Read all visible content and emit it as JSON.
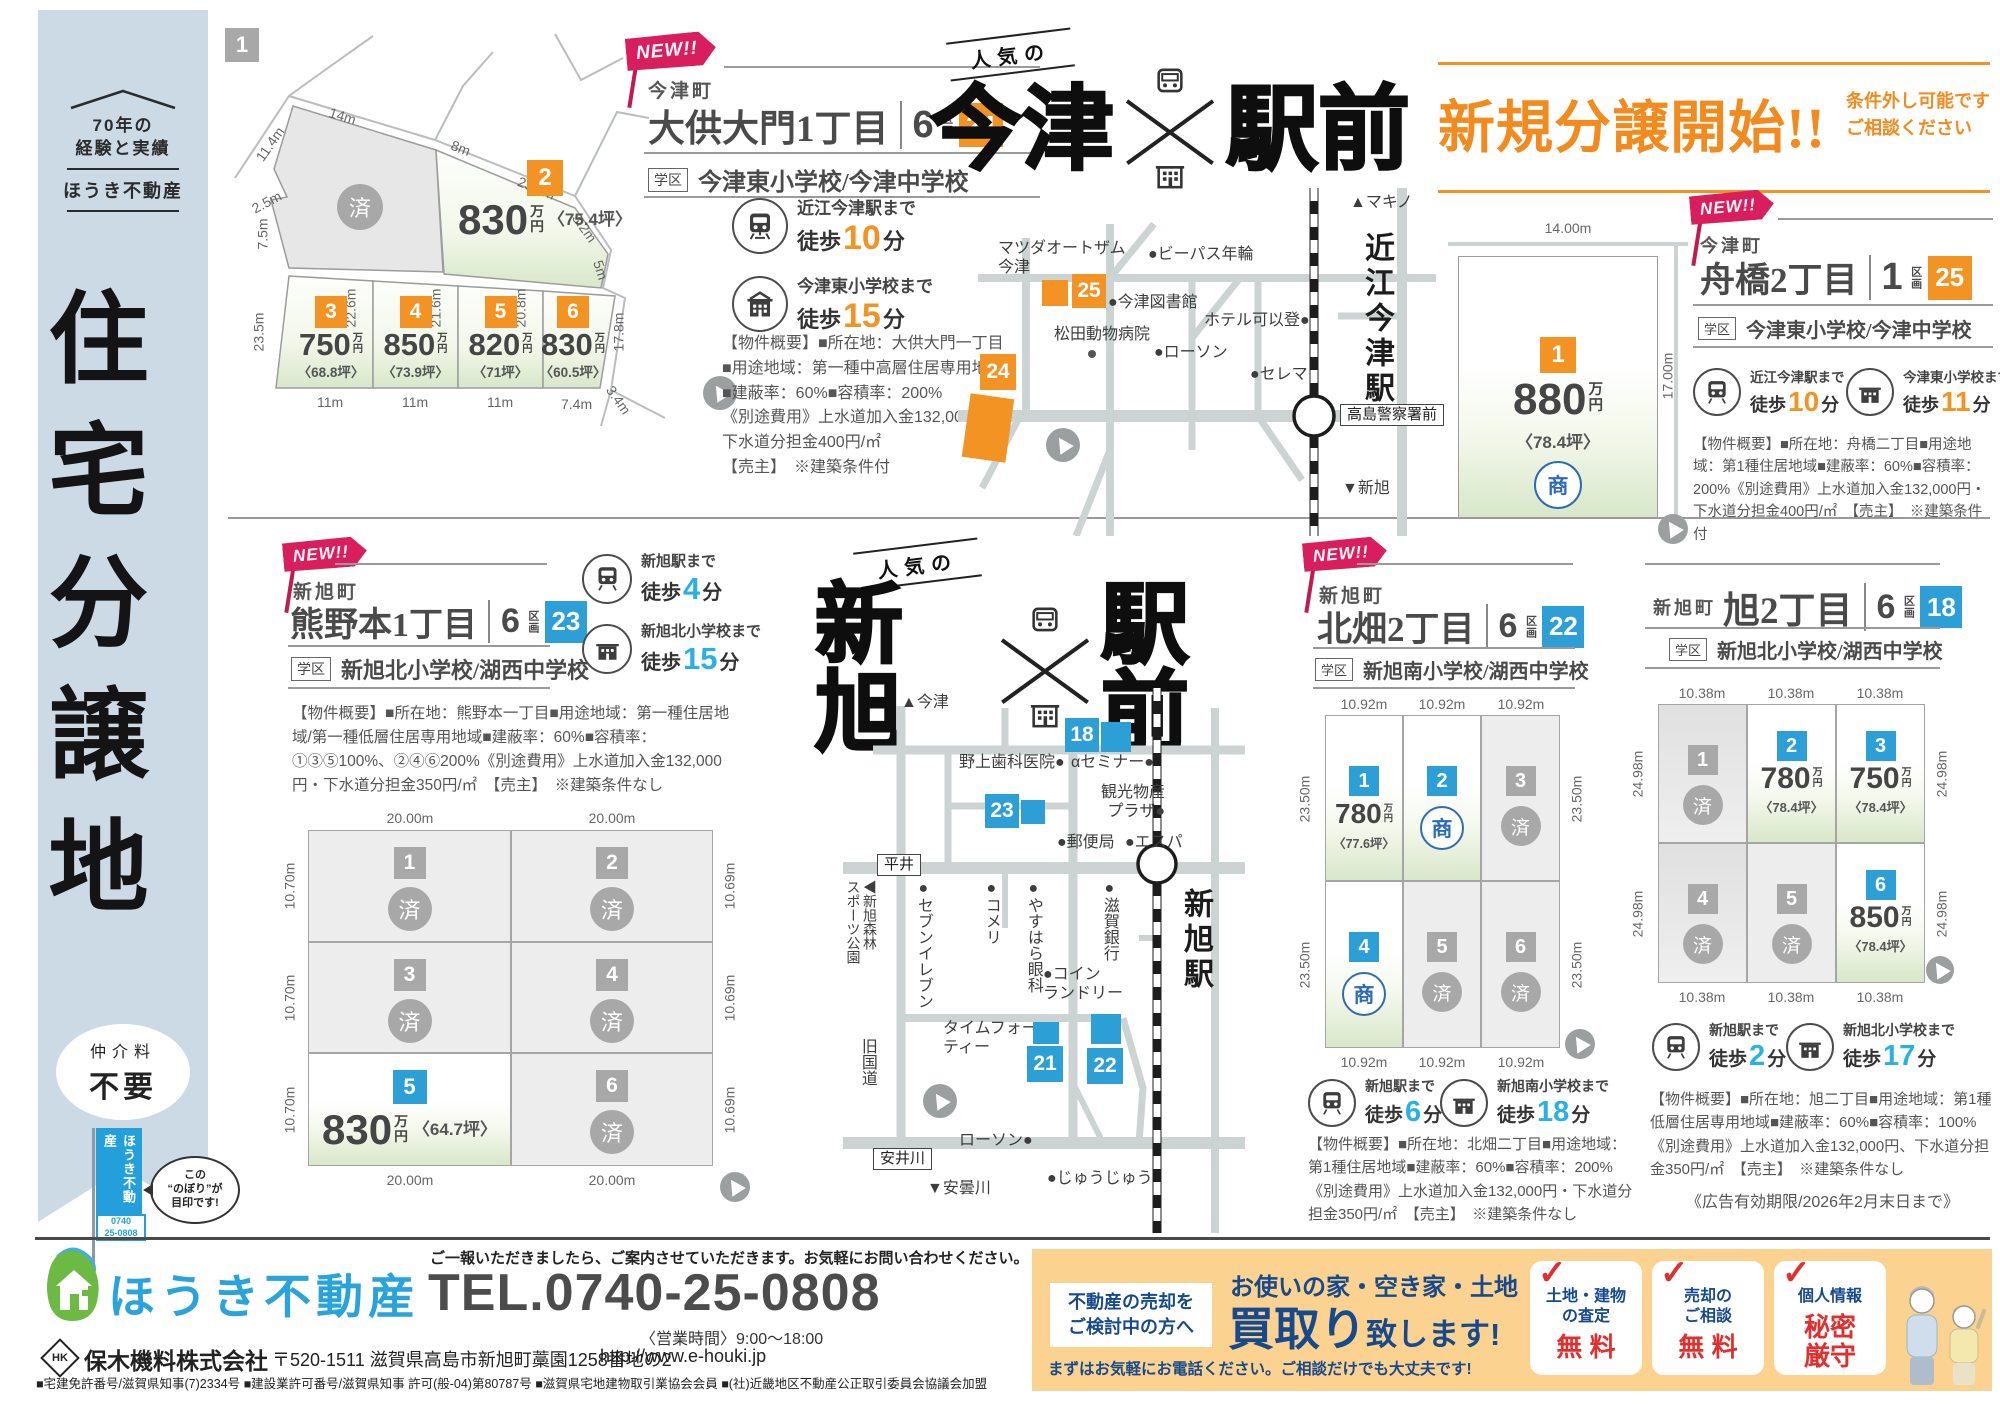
{
  "units": {
    "new": "NEW!!",
    "ku": "区画",
    "gakku": "学区",
    "walk": "徒歩",
    "min": "分",
    "man": "万",
    "yen": "円",
    "sold": "済",
    "sho": "商"
  },
  "sidebar": {
    "tag1": "70年の",
    "tag2": "経験と実績",
    "brand": "ほうき不動産",
    "title": "住宅分譲地",
    "oval1": "仲介料",
    "oval2": "不要",
    "flag": "ほうき不動産",
    "tel1": "0740",
    "tel2": "25-0808",
    "bubble": "この\n“のぼり”が\n目印です!"
  },
  "banner": {
    "title": "新規分譲開始!!",
    "note": "条件外し可能です\nご相談ください"
  },
  "bigtitle": {
    "tag": "人気の",
    "imazu": "今津",
    "shin": "新旭",
    "ekimae": "駅前"
  },
  "s24": {
    "town": "今津町",
    "name": "大供大門1丁目",
    "num": "6",
    "badge": "24",
    "schools": "今津東小学校/今津中学校",
    "access": [
      {
        "dest": "近江今津駅まで",
        "min": "10"
      },
      {
        "dest": "今津東小学校まで",
        "min": "15"
      }
    ],
    "overview": "【物件概要】■所在地：大供大門一丁目\n■用途地域：第一種中高層住居専用地域\n■建蔽率：60%■容積率：200%\n《別途費用》上水道加入金132,000円・\n下水道分担金400円/㎡\n【売主】　※建築条件付",
    "lots": {
      "l1": "1",
      "l2": "2",
      "l3": "3",
      "l4": "4",
      "l5": "5",
      "l6": "6",
      "p2": "830",
      "t2": "〈75.4坪〉",
      "p3": "750",
      "t3": "〈68.8坪〉",
      "p4": "850",
      "t4": "〈73.9坪〉",
      "p5": "820",
      "t5": "〈71坪〉",
      "p6": "830",
      "t6": "〈60.5坪〉"
    },
    "dims": [
      "11.4m",
      "14m",
      "8m",
      "23.8m",
      "2.5m",
      "7.5m",
      "3.2m",
      "5m",
      "22.6m",
      "21.6m",
      "20.8m",
      "23.5m",
      "17.8m",
      "3.4m",
      "11m",
      "11m",
      "11m",
      "7.4m"
    ]
  },
  "map_imazu": {
    "up": "▲マキノ",
    "down": "▼新旭",
    "station": "近江今津駅",
    "police": "高島警察署前",
    "l24": "24",
    "l25": "25",
    "a": "マツダオートザム\n今津",
    "b": "●ビーパス年輪",
    "c": "●今津図書館",
    "d": "松田動物病院",
    "e": "●ローソン",
    "f": "ホテル可以登●",
    "g": "●セレマ"
  },
  "s25": {
    "town": "今津町",
    "name": "舟橋2丁目",
    "num": "1",
    "badge": "25",
    "schools": "今津東小学校/今津中学校",
    "access": [
      {
        "dest": "近江今津駅まで",
        "min": "10"
      },
      {
        "dest": "今津東小学校まで",
        "min": "11"
      }
    ],
    "overview": "【物件概要】■所在地：舟橋二丁目■用途地域：第1種住居地域■建蔽率：60%■容積率：200%《別途費用》上水道加入金132,000円・下水道分担金400円/㎡　【売主】　※建築条件付",
    "lot": "1",
    "price": "880",
    "tsubo": "〈78.4坪〉",
    "dimw": "14.00m",
    "dimh": "17.00m"
  },
  "s23": {
    "town": "新旭町",
    "name": "熊野本1丁目",
    "num": "6",
    "badge": "23",
    "schools": "新旭北小学校/湖西中学校",
    "access": [
      {
        "dest": "新旭駅まで",
        "min": "4"
      },
      {
        "dest": "新旭北小学校まで",
        "min": "15"
      }
    ],
    "overview": "【物件概要】■所在地：熊野本一丁目■用途地域：第一種住居地域/第一種低層住居専用地域■建蔽率：60%■容積率：①③⑤100%、②④⑥200%《別途費用》上水道加入金132,000円・下水道分担金350円/㎡　【売主】　※建築条件なし",
    "lots": [
      "1",
      "2",
      "3",
      "4",
      "5",
      "6"
    ],
    "price5": "830",
    "tsubo5": "〈64.7坪〉",
    "dimt": "20.00m",
    "dimb": "20.00m",
    "diml": "10.70m",
    "dimr": "10.69m"
  },
  "map_shin": {
    "up": "▲今津",
    "down": "▼安曇川",
    "station": "新旭駅",
    "hirai": "平井",
    "yasui": "安井川",
    "road": "旧国道",
    "park": "◀新旭森林\nスポーツ公園",
    "l18": "18",
    "l21": "21",
    "l22": "22",
    "l23": "23",
    "a": "野上歯科医院●",
    "b": "αセミナー●",
    "c": "観光物産\nプラザ●",
    "d": "●郵便局",
    "e": "●エスパ",
    "f": "●セブンイレブン",
    "g": "●コメリ",
    "h": "●やすはら眼科",
    "i": "●滋賀銀行",
    "j": "●コイン\nランドリー",
    "k": "タイムフォー●\nティー",
    "l": "ローソン●",
    "m": "●じゅうじゅう"
  },
  "s22": {
    "town": "新旭町",
    "name": "北畑2丁目",
    "num": "6",
    "badge": "22",
    "schools": "新旭南小学校/湖西中学校",
    "access": [
      {
        "dest": "新旭駅まで",
        "min": "6"
      },
      {
        "dest": "新旭南小学校まで",
        "min": "18"
      }
    ],
    "overview": "【物件概要】■所在地：北畑二丁目■用途地域：第1種住居地域■建蔽率：60%■容積率：200%《別途費用》上水道加入金132,000円・下水道分担金350円/㎡　【売主】　※建築条件なし",
    "lots": [
      "1",
      "2",
      "3",
      "4",
      "5",
      "6"
    ],
    "price1": "780",
    "tsubo1": "〈77.6坪〉",
    "dimh": "10.92m",
    "dimv": "23.50m"
  },
  "s18": {
    "town": "新旭町",
    "name": "旭2丁目",
    "num": "6",
    "badge": "18",
    "schools": "新旭北小学校/湖西中学校",
    "access": [
      {
        "dest": "新旭駅まで",
        "min": "2"
      },
      {
        "dest": "新旭北小学校まで",
        "min": "17"
      }
    ],
    "overview": "【物件概要】■所在地：旭二丁目■用途地域：第1種低層住居専用地域■建蔽率：60%■容積率：100%《別途費用》上水道加入金132,000円、下水道分担金350円/㎡　【売主】　※建築条件なし",
    "expiry": "《広告有効期限/2026年2月末日まで》",
    "lots": [
      "1",
      "2",
      "3",
      "4",
      "5",
      "6"
    ],
    "price2": "780",
    "tsubo2": "〈78.4坪〉",
    "price3": "750",
    "tsubo3": "〈78.4坪〉",
    "price6": "850",
    "tsubo6": "〈78.4坪〉",
    "dimh": "10.38m",
    "dimv": "24.98m"
  },
  "footer": {
    "brand": "ほうき不動産",
    "note": "ご一報いただきましたら、ご案内させていただきます。お気軽にお問い合わせください。",
    "tel": "TEL.0740-25-0808",
    "hours": "〈営業時間〉9:00～18:00",
    "mark": "HK",
    "company": "保木機料株式会社",
    "address": "〒520-1511 滋賀県高島市新旭町藁園1258番地の2",
    "url": "http://www.e-houki.jp",
    "licenses": "■宅建免許番号/滋賀県知事(7)2334号 ■建設業許可番号/滋賀県知事 許可(般-04)第80787号 ■滋賀県宅地建物取引業協会会員 ■(社)近畿地区不動産公正取引委員会協議会加盟"
  },
  "promo": {
    "lead": "不動産の売却を\nご検討中の方へ",
    "h1": "お使いの家・空き家・土地",
    "h2a": "買取り",
    "h2b": "致します!",
    "sub": "まずはお気軽にお電話ください。ご相談だけでも大丈夫です!",
    "check": "✓",
    "c1l": "土地・建物\nの査定",
    "c1v": "無 料",
    "c2l": "売却の\nご相談",
    "c2v": "無 料",
    "c3l": "個人情報",
    "c3v": "秘密\n厳守"
  }
}
